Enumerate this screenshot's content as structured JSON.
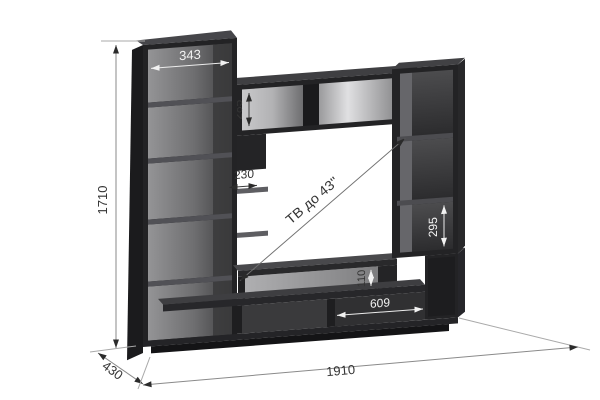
{
  "diagram": {
    "type": "furniture-dimension-drawing",
    "subject": "TV wall unit with open shelving",
    "background_color": "#ffffff",
    "furniture_color": "#232325",
    "interior_light_color": "#929294",
    "dim_text_dark_color": "#343434",
    "dim_text_light_color": "#f2f2f2",
    "tv_label": "ТВ до 43\"",
    "dims": {
      "top_box_width": "343",
      "bridge_height": "285",
      "spine_depth": "230",
      "total_height": "1710",
      "right_compartment_height": "295",
      "shelf_gap": "110",
      "bottom_compartment_width": "609",
      "total_width": "1910",
      "total_depth": "430"
    }
  }
}
